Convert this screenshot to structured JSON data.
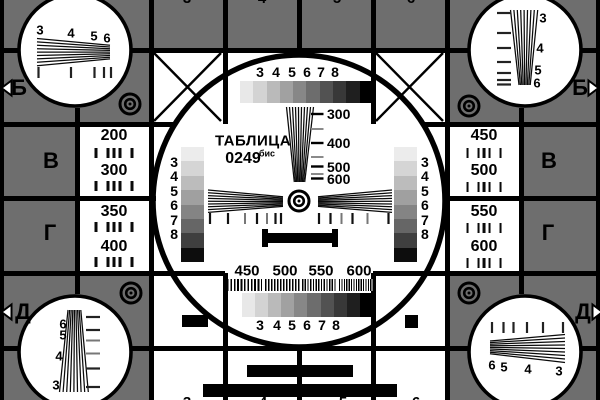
{
  "title": {
    "name": "ТАБЛИЦА",
    "code": "0249",
    "suffix": "бис"
  },
  "rows": {
    "left": [
      "Б",
      "В",
      "Г",
      "Д"
    ],
    "right": [
      "Б",
      "В",
      "Г",
      "Д"
    ]
  },
  "columns": {
    "top": [
      "3",
      "4",
      "5",
      "6"
    ],
    "bottom": [
      "3",
      "4",
      "5",
      "6"
    ]
  },
  "gray_steps_labels": [
    "3",
    "4",
    "5",
    "6",
    "7",
    "8"
  ],
  "resolution_marks": [
    "300",
    "400",
    "500",
    "600"
  ],
  "burst_marks": [
    "450",
    "500",
    "550",
    "600"
  ],
  "freq_cells": {
    "left": [
      [
        "200",
        "300"
      ],
      [
        "350",
        "400"
      ]
    ],
    "right": [
      [
        "450",
        "500"
      ],
      [
        "550",
        "600"
      ]
    ]
  },
  "corner_wedges": {
    "top_left": [
      "3",
      "4",
      "5",
      "6"
    ],
    "top_right": [
      "3",
      "4",
      "5",
      "6"
    ],
    "bottom_left": [
      "6",
      "5",
      "4",
      "3"
    ],
    "bottom_right": [
      "6",
      "5",
      "4",
      "3"
    ]
  },
  "colors": {
    "background": "#6e6e6e",
    "line": "#000000",
    "white": "#ffffff",
    "grayscale_bar": [
      "#e8e8e8",
      "#d3d3d3",
      "#bababa",
      "#a1a1a1",
      "#878787",
      "#6d6d6d",
      "#525252",
      "#383838",
      "#1f1f1f",
      "#000000"
    ],
    "staircase": [
      "#ececec",
      "#d5d5d5",
      "#bcbcbc",
      "#a0a0a0",
      "#848484",
      "#666666",
      "#3f3f3f",
      "#0d0d0d"
    ]
  }
}
